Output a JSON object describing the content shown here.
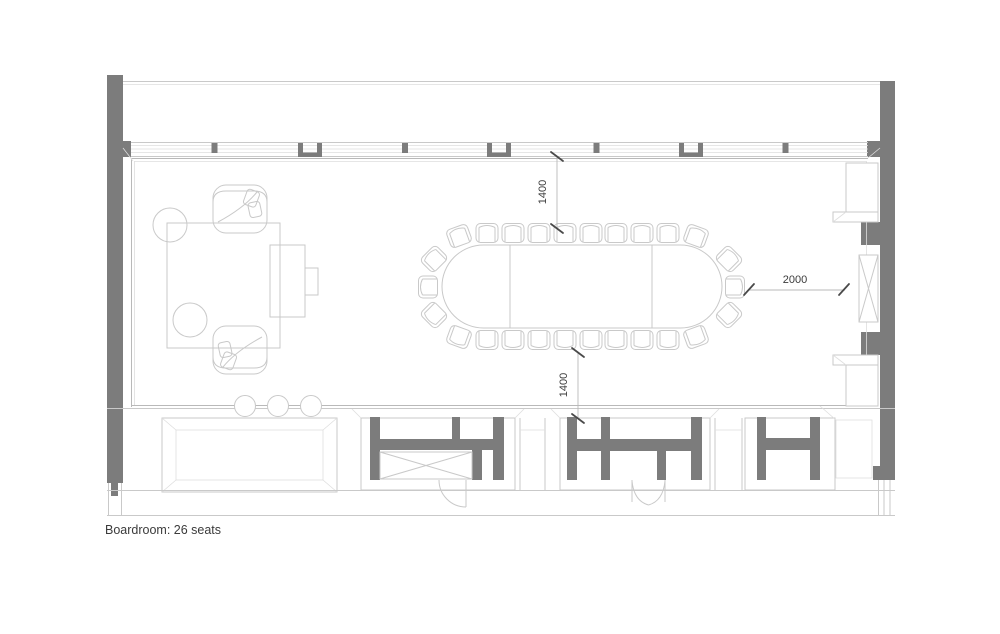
{
  "plan": {
    "caption": "Boardroom: 26 seats",
    "seat_count": "26",
    "room_name": "Boardroom",
    "dimensions": {
      "window_to_table": "1400",
      "table_to_core_wall": "1400",
      "table_to_east_wall": "2000"
    },
    "colors": {
      "wall_fill": "#7c7c7c",
      "line_light": "#c9c9c9",
      "line_mid": "#b9b9b9",
      "line_faint": "#dedede",
      "dim_tick": "#4a4a4a",
      "text_color": "#3b3b3b",
      "background": "#ffffff"
    }
  }
}
